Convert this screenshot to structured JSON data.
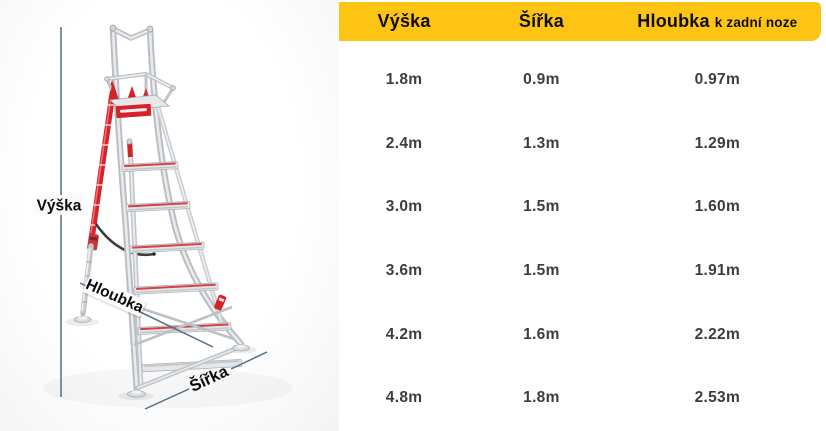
{
  "diagram": {
    "labels": {
      "height": "Výška",
      "depth": "Hloubka",
      "width": "Šířka"
    }
  },
  "table": {
    "headers": {
      "col1": "Výška",
      "col2": "Šířka",
      "col3_main": "Hloubka",
      "col3_suffix": "k zadní noze"
    },
    "rows": [
      [
        "1.8m",
        "0.9m",
        "0.97m"
      ],
      [
        "2.4m",
        "1.3m",
        "1.29m"
      ],
      [
        "3.0m",
        "1.5m",
        "1.60m"
      ],
      [
        "3.6m",
        "1.5m",
        "1.91m"
      ],
      [
        "4.2m",
        "1.6m",
        "2.22m"
      ],
      [
        "4.8m",
        "1.8m",
        "2.53m"
      ]
    ]
  },
  "colors": {
    "header_bg": "#fdc414",
    "header_text": "#0d0d0d",
    "value_text": "#3d3d3d",
    "dimension_line": "#546d83",
    "ladder_red": "#d6232a",
    "ladder_silver": "#c3c8cc"
  }
}
